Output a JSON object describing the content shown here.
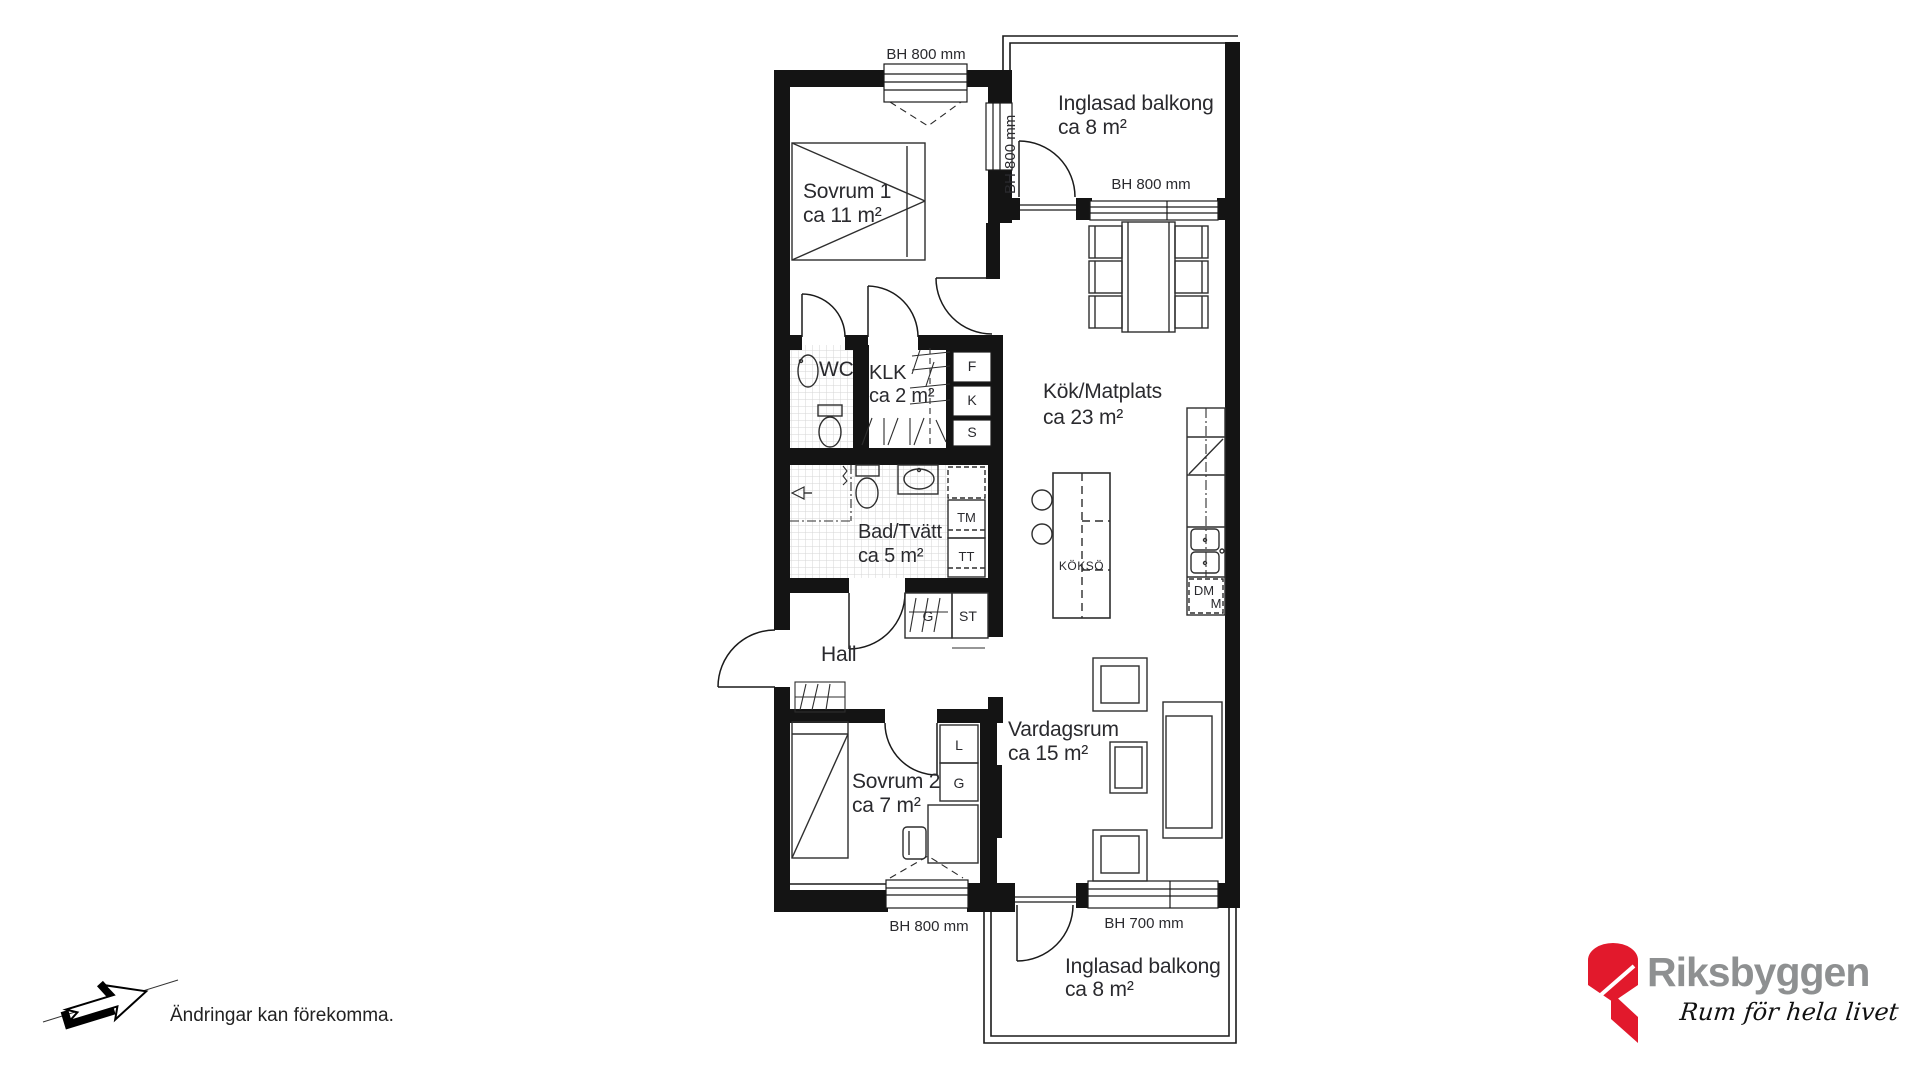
{
  "floorplan": {
    "windows": {
      "sovrum1_top": "BH 800 mm",
      "balkong_side": "BH 800 mm",
      "kok_top": "BH 800 mm",
      "sovrum2_bottom": "BH 800 mm",
      "vardagsrum_bottom": "BH 700 mm"
    },
    "rooms": {
      "balkong_top": {
        "name": "Inglasad balkong",
        "area": "ca 8 m²"
      },
      "sovrum1": {
        "name": "Sovrum 1",
        "area": "ca 11 m²"
      },
      "wc": {
        "name": "WC"
      },
      "klk": {
        "name": "KLK",
        "area": "ca 2 m²"
      },
      "kok": {
        "name": "Kök/Matplats",
        "area": "ca 23 m²"
      },
      "bad": {
        "name": "Bad/Tvätt",
        "area": "ca 5 m²"
      },
      "hall": {
        "name": "Hall"
      },
      "sovrum2": {
        "name": "Sovrum 2",
        "area": "ca 7 m²"
      },
      "vardagsrum": {
        "name": "Vardagsrum",
        "area": "ca 15 m²"
      },
      "balkong_bottom": {
        "name": "Inglasad balkong",
        "area": "ca 8 m²"
      }
    },
    "fixtures": {
      "f": "F",
      "k": "K",
      "s": "S",
      "tm": "TM",
      "tt": "TT",
      "kokso": "KÖKSÖ",
      "dm": "DM",
      "m": "M",
      "g_hall": "G",
      "st": "ST",
      "l": "L",
      "g_sovrum2": "G"
    }
  },
  "footer": {
    "disclaimer": "Ändringar kan förekomma."
  },
  "branding": {
    "name": "Riksbyggen",
    "tagline": "Rum för hela livet",
    "colors": {
      "red": "#e2192c",
      "gray": "#8e9091",
      "wall": "#141414"
    }
  }
}
